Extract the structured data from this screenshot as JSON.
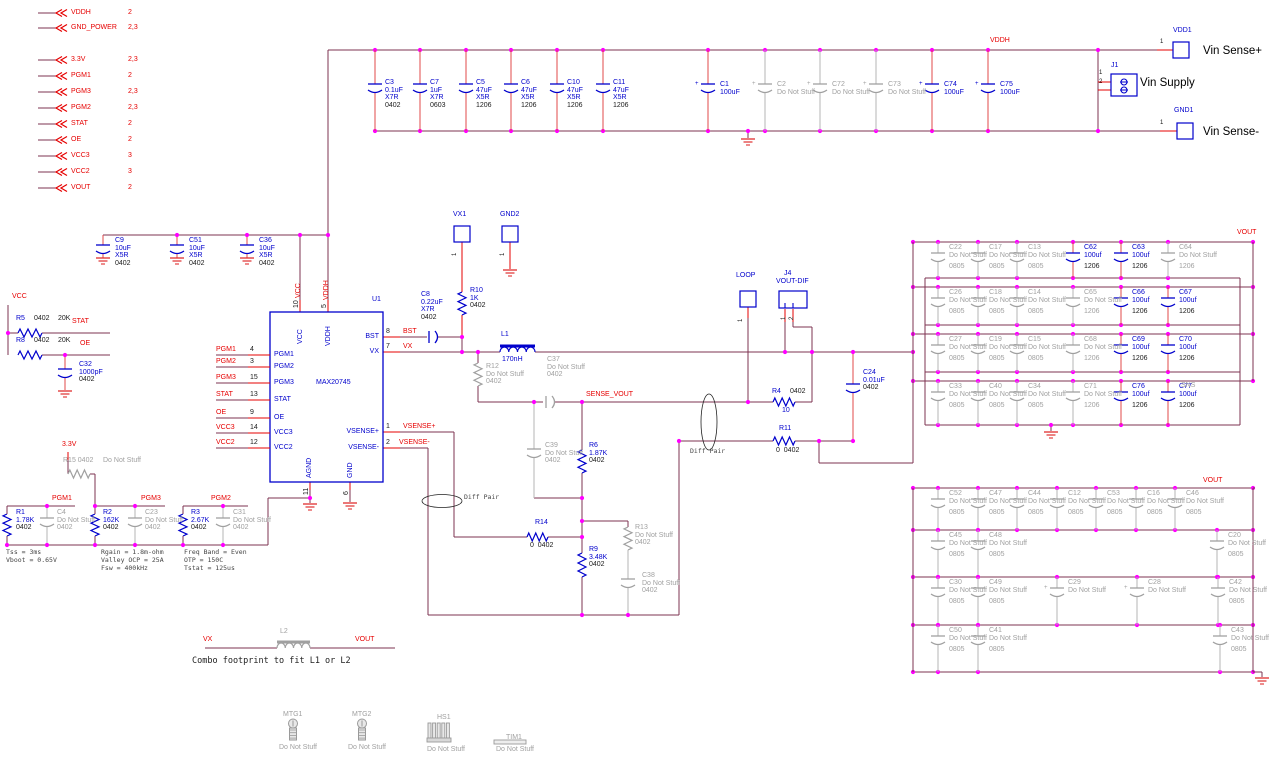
{
  "net_flags": [
    {
      "name": "VDDH",
      "pages": "2"
    },
    {
      "name": "GND_POWER",
      "pages": "2,3"
    },
    {
      "name": "3.3V",
      "pages": "2,3"
    },
    {
      "name": "PGM1",
      "pages": "2"
    },
    {
      "name": "PGM3",
      "pages": "2,3"
    },
    {
      "name": "PGM2",
      "pages": "2,3"
    },
    {
      "name": "STAT",
      "pages": "2"
    },
    {
      "name": "OE",
      "pages": "2"
    },
    {
      "name": "VCC3",
      "pages": "3"
    },
    {
      "name": "VCC2",
      "pages": "3"
    },
    {
      "name": "VOUT",
      "pages": "2"
    }
  ],
  "nets": {
    "vddh_top": "VDDH",
    "vcc": "VCC",
    "stat": "STAT",
    "oe": "OE",
    "v33": "3.3V",
    "pgm1": "PGM1",
    "pgm3": "PGM3",
    "pgm2": "PGM2",
    "sense_vout": "SENSE_VOUT",
    "vx_l2": "VX",
    "vout_l2": "VOUT",
    "vout_top": "VOUT",
    "vout_bottom": "VOUT",
    "sns": "SNS",
    "vcc_v": "VCC",
    "vddh_v": "VDDH"
  },
  "u1": {
    "ref": "U1",
    "part": "MAX20745",
    "top_pins": [
      {
        "name": "VCC",
        "num": "10"
      },
      {
        "name": "VDDH",
        "num": "5"
      }
    ],
    "left_pins": [
      {
        "name": "PGM1",
        "num": "4",
        "net": "PGM1"
      },
      {
        "name": "PGM2",
        "num": "3",
        "net": "PGM2"
      },
      {
        "name": "PGM3",
        "num": "15",
        "net": "PGM3"
      },
      {
        "name": "STAT",
        "num": "13",
        "net": "STAT"
      },
      {
        "name": "OE",
        "num": "9",
        "net": "OE"
      },
      {
        "name": "VCC3",
        "num": "14",
        "net": "VCC3"
      },
      {
        "name": "VCC2",
        "num": "12",
        "net": "VCC2"
      }
    ],
    "right_pins": [
      {
        "name": "BST",
        "num": "8",
        "net": "BST"
      },
      {
        "name": "VX",
        "num": "7",
        "net": "VX"
      },
      {
        "name": "VSENSE+",
        "num": "1",
        "net": "VSENSE+"
      },
      {
        "name": "VSENSE-",
        "num": "2",
        "net": "VSENSE-"
      }
    ],
    "bottom_pins": [
      {
        "name": "AGND",
        "num": "11"
      },
      {
        "name": "GND",
        "num": "6"
      }
    ]
  },
  "input_bank": {
    "caps": [
      {
        "ref": "C3",
        "lines": [
          "0.1uF",
          "X7R",
          "0402"
        ],
        "stuffed": true
      },
      {
        "ref": "C7",
        "lines": [
          "1uF",
          "X7R",
          "0603"
        ],
        "stuffed": true
      },
      {
        "ref": "C5",
        "lines": [
          "47uF",
          "X5R",
          "1206"
        ],
        "stuffed": true
      },
      {
        "ref": "C6",
        "lines": [
          "47uF",
          "X5R",
          "1206"
        ],
        "stuffed": true
      },
      {
        "ref": "C10",
        "lines": [
          "47uF",
          "X5R",
          "1206"
        ],
        "stuffed": true
      },
      {
        "ref": "C11",
        "lines": [
          "47uF",
          "X5R",
          "1206"
        ],
        "stuffed": true
      },
      {
        "ref": "C1",
        "lines": [
          "100uF"
        ],
        "stuffed": true
      },
      {
        "ref": "C2",
        "lines": [
          "Do Not Stuff"
        ],
        "stuffed": false
      },
      {
        "ref": "C72",
        "lines": [
          "Do Not Stuff"
        ],
        "stuffed": false
      },
      {
        "ref": "C73",
        "lines": [
          "Do Not Stuff"
        ],
        "stuffed": false
      },
      {
        "ref": "C74",
        "lines": [
          "100uF"
        ],
        "stuffed": true
      },
      {
        "ref": "C75",
        "lines": [
          "100uF"
        ],
        "stuffed": true
      }
    ]
  },
  "vcc_bank": {
    "caps": [
      {
        "ref": "C9",
        "lines": [
          "10uF",
          "X5R",
          "0402"
        ]
      },
      {
        "ref": "C51",
        "lines": [
          "10uF",
          "X5R",
          "0402"
        ]
      },
      {
        "ref": "C36",
        "lines": [
          "10uF",
          "X5R",
          "0402"
        ]
      }
    ]
  },
  "connectors": {
    "j1": {
      "ref": "J1",
      "label": "Vin Supply",
      "pins": [
        "1",
        "2"
      ]
    },
    "j4": {
      "ref": "J4",
      "net": "VOUT-DIF",
      "pins": [
        "1",
        "2"
      ]
    },
    "vdd1": {
      "ref": "VDD1",
      "pin": "1",
      "label": "Vin Sense+"
    },
    "gnd1": {
      "ref": "GND1",
      "pin": "1",
      "label": "Vin Sense-"
    }
  },
  "testpoints": {
    "vx1": {
      "ref": "VX1",
      "pin": "1"
    },
    "gnd2": {
      "ref": "GND2",
      "pin": "1"
    },
    "loop": {
      "ref": "LOOP",
      "pin": "1"
    }
  },
  "parts": {
    "r5": {
      "lines": [
        "R5",
        "0402",
        "20K"
      ]
    },
    "r8": {
      "lines": [
        "R8",
        "0402",
        "20K"
      ]
    },
    "c32": {
      "lines": [
        "C32",
        "1000pF",
        "0402"
      ]
    },
    "r15": {
      "label": "R15 0402",
      "note": "Do Not Stuff"
    },
    "r1": {
      "lines": [
        "R1",
        "1.78K",
        "0402"
      ]
    },
    "c4": {
      "lines": [
        "C4",
        "Do Not Stuff",
        "0402"
      ]
    },
    "r2": {
      "lines": [
        "R2",
        "162K",
        "0402"
      ]
    },
    "c23": {
      "lines": [
        "C23",
        "Do Not Stuff",
        "0402"
      ]
    },
    "r3": {
      "lines": [
        "R3",
        "2.67K",
        "0402"
      ]
    },
    "c31": {
      "lines": [
        "C31",
        "Do Not Stuff",
        "0402"
      ]
    },
    "c8": {
      "lines": [
        "C8",
        "0.22uF",
        "X7R",
        "0402"
      ]
    },
    "r10": {
      "lines": [
        "R10",
        "1K",
        "0402"
      ]
    },
    "l1": {
      "ref": "L1",
      "value": "170nH"
    },
    "l2": {
      "ref": "L2"
    },
    "r12": {
      "lines": [
        "R12",
        "Do Not Stuff",
        "0402"
      ]
    },
    "c37": {
      "lines": [
        "C37",
        "Do Not Stuff",
        "0402"
      ]
    },
    "c39": {
      "lines": [
        "C39",
        "Do Not Stuff",
        "0402"
      ]
    },
    "r6": {
      "lines": [
        "R6",
        "1.87K",
        "0402"
      ]
    },
    "r14": {
      "ref": "R14",
      "value": "0  0402"
    },
    "r13": {
      "lines": [
        "R13",
        "Do Not Stuff",
        "0402"
      ]
    },
    "r9": {
      "lines": [
        "R9",
        "3.48K",
        "0402"
      ]
    },
    "c38": {
      "lines": [
        "C38",
        "Do Not Stuff",
        "0402"
      ]
    },
    "r4": {
      "ref": "R4",
      "size": "0402",
      "value": "10"
    },
    "r11": {
      "ref": "R11",
      "value": "0  0402"
    },
    "c24": {
      "lines": [
        "C24",
        "0.01uF",
        "0402"
      ]
    }
  },
  "out_bank_top": {
    "rows": [
      [
        {
          "ref": "C22",
          "val": "Do Not Stuff",
          "size": "0805",
          "stuffed": false
        },
        {
          "ref": "C17",
          "val": "Do Not Stuff",
          "size": "0805",
          "stuffed": false
        },
        {
          "ref": "C13",
          "val": "Do Not Stuff",
          "size": "0805",
          "stuffed": false
        },
        {
          "ref": "C62",
          "val": "100uf",
          "size": "1206",
          "stuffed": true
        },
        {
          "ref": "C63",
          "val": "100uf",
          "size": "1206",
          "stuffed": true
        },
        {
          "ref": "C64",
          "val": "Do Not Stuff",
          "size": "1206",
          "stuffed": false
        }
      ],
      [
        {
          "ref": "C26",
          "val": "Do Not Stuff",
          "size": "0805",
          "stuffed": false
        },
        {
          "ref": "C18",
          "val": "Do Not Stuff",
          "size": "0805",
          "stuffed": false
        },
        {
          "ref": "C14",
          "val": "Do Not Stuff",
          "size": "0805",
          "stuffed": false
        },
        {
          "ref": "C65",
          "val": "Do Not Stuff",
          "size": "1206",
          "stuffed": false
        },
        {
          "ref": "C66",
          "val": "100uf",
          "size": "1206",
          "stuffed": true
        },
        {
          "ref": "C67",
          "val": "100uf",
          "size": "1206",
          "stuffed": true
        }
      ],
      [
        {
          "ref": "C27",
          "val": "Do Not Stuff",
          "size": "0805",
          "stuffed": false
        },
        {
          "ref": "C19",
          "val": "Do Not Stuff",
          "size": "0805",
          "stuffed": false
        },
        {
          "ref": "C15",
          "val": "Do Not Stuff",
          "size": "0805",
          "stuffed": false
        },
        {
          "ref": "C68",
          "val": "Do Not Stuff",
          "size": "1206",
          "stuffed": false
        },
        {
          "ref": "C69",
          "val": "100uf",
          "size": "1206",
          "stuffed": true
        },
        {
          "ref": "C70",
          "val": "100uf",
          "size": "1206",
          "stuffed": true
        }
      ],
      [
        {
          "ref": "C33",
          "val": "Do Not Stuff",
          "size": "0805",
          "stuffed": false
        },
        {
          "ref": "C40",
          "val": "Do Not Stuff",
          "size": "0805",
          "stuffed": false
        },
        {
          "ref": "C34",
          "val": "Do Not Stuff",
          "size": "0805",
          "stuffed": false
        },
        {
          "ref": "C71",
          "val": "Do Not Stuff",
          "size": "1206",
          "stuffed": false
        },
        {
          "ref": "C76",
          "val": "100uf",
          "size": "1206",
          "stuffed": true
        },
        {
          "ref": "C77",
          "val": "100uf",
          "size": "1206",
          "stuffed": true
        }
      ]
    ]
  },
  "out_bank_bottom": {
    "rows": [
      [
        {
          "ref": "C52",
          "val": "Do Not Stuff",
          "size": "0805",
          "stuffed": false
        },
        {
          "ref": "C47",
          "val": "Do Not Stuff",
          "size": "0805",
          "stuffed": false
        },
        {
          "ref": "C44",
          "val": "Do Not Stuff",
          "size": "0805",
          "stuffed": false
        },
        {
          "ref": "C12",
          "val": "Do Not Stuff",
          "size": "0805",
          "stuffed": false
        },
        {
          "ref": "C53",
          "val": "Do Not Stuff",
          "size": "0805",
          "stuffed": false
        },
        {
          "ref": "C16",
          "val": "Do Not Stuff",
          "size": "0805",
          "stuffed": false
        },
        {
          "ref": "C46",
          "val": "Do Not Stuff",
          "size": "0805",
          "stuffed": false
        }
      ],
      [
        {
          "ref": "C45",
          "val": "Do Not Stuff",
          "size": "0805",
          "stuffed": false
        },
        {
          "ref": "C48",
          "val": "Do Not Stuff",
          "size": "0805",
          "stuffed": false
        },
        {
          "ref": "C20",
          "val": "Do Not Stuff",
          "size": "0805",
          "stuffed": false
        }
      ],
      [
        {
          "ref": "C30",
          "val": "Do Not Stuff",
          "size": "0805",
          "stuffed": false
        },
        {
          "ref": "C49",
          "val": "Do Not Stuff",
          "size": "0805",
          "stuffed": false
        },
        {
          "ref": "C29",
          "val": "Do Not Stuff",
          "size": "",
          "stuffed": false,
          "pol": true
        },
        {
          "ref": "C28",
          "val": "Do Not Stuff",
          "size": "",
          "stuffed": false,
          "pol": true
        },
        {
          "ref": "C42",
          "val": "Do Not Stuff",
          "size": "0805",
          "stuffed": false
        }
      ],
      [
        {
          "ref": "C50",
          "val": "Do Not Stuff",
          "size": "0805",
          "stuffed": false
        },
        {
          "ref": "C41",
          "val": "Do Not Stuff",
          "size": "0805",
          "stuffed": false
        },
        {
          "ref": "C43",
          "val": "Do Not Stuff",
          "size": "0805",
          "stuffed": false
        }
      ]
    ]
  },
  "notes": {
    "n1": [
      "Tss = 3ms",
      "Vboot = 0.65V"
    ],
    "n2": [
      "Rgain = 1.8m-ohm",
      "Valley OCP = 25A",
      "Fsw = 400kHz"
    ],
    "n3": [
      "Freq Band = Even",
      "OTP = 150C",
      "Tstat = 125us"
    ]
  },
  "annotations": {
    "diff_pair_a": "Diff Pair",
    "diff_pair_b": "Diff Pair",
    "combo": "Combo footprint to fit L1 or L2"
  },
  "mech": [
    {
      "ref": "MTG1",
      "note": "Do Not Stuff",
      "icon": "screw"
    },
    {
      "ref": "MTG2",
      "note": "Do Not Stuff",
      "icon": "screw"
    },
    {
      "ref": "HS1",
      "note": "Do Not Stuff",
      "icon": "heatsink"
    },
    {
      "ref": "TIM1",
      "note": "Do Not Stuff",
      "icon": "thermal-pad"
    }
  ],
  "colors": {
    "wire": "#7e3350",
    "net": "#e60000",
    "comp": "#0000cc",
    "dns": "#a0a0a0",
    "junction": "#ff00ff",
    "ground": "#e03030",
    "lead": "#e04848",
    "dnslead": "#b5b5b5"
  }
}
